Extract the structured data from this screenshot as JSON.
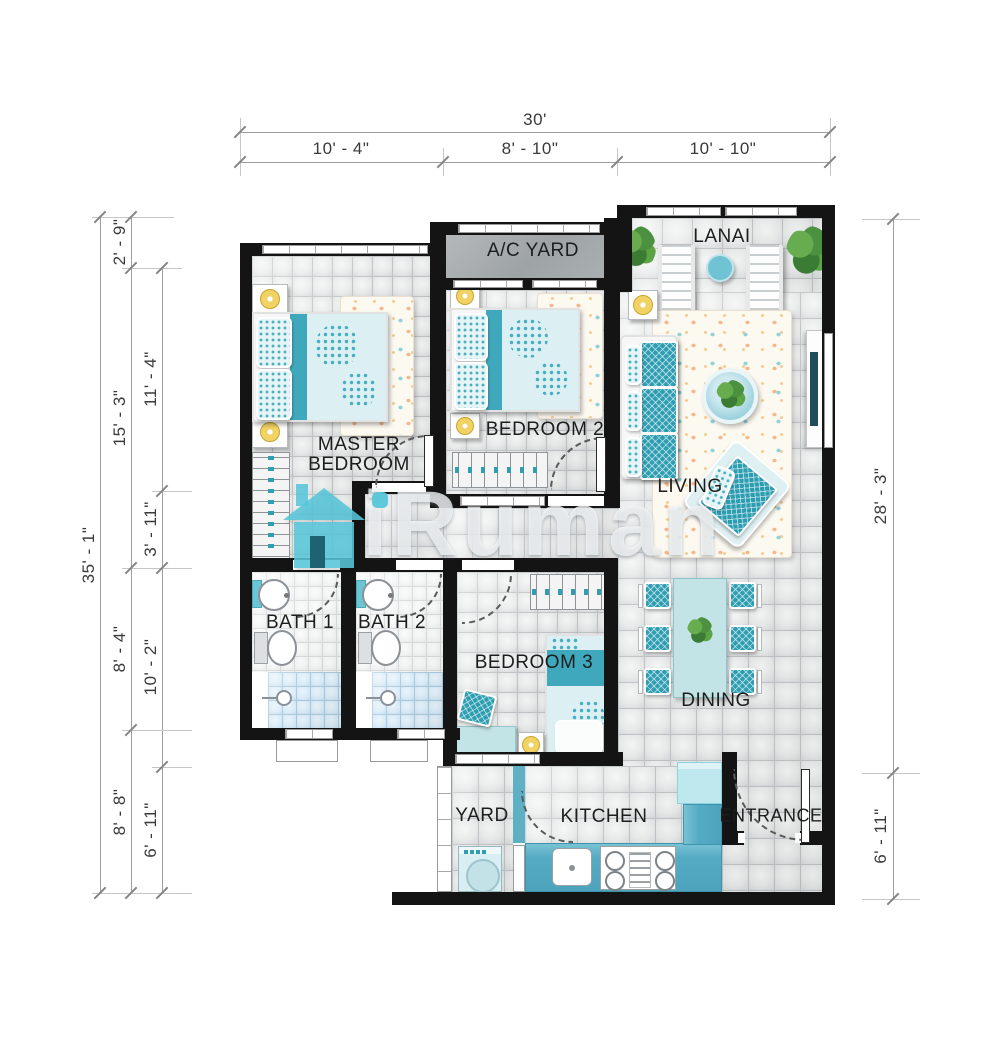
{
  "watermark": {
    "brand": "iRuman",
    "accent": "#56c5d8",
    "house_icon": "house-icon"
  },
  "dimensions": {
    "top": {
      "total": "30'",
      "segments": [
        "10' - 4\"",
        "8' - 10\"",
        "10' - 10\""
      ]
    },
    "left_outer": "35' - 1\"",
    "left_middle": [
      "2' - 9\"",
      "15' - 3\"",
      "8' - 4\"",
      "8' - 8\""
    ],
    "left_inner": [
      "11' - 4\"",
      "3' - 11\"",
      "10' - 2\"",
      "6' - 11\""
    ],
    "right": [
      "28' - 3\"",
      "6' - 11\""
    ]
  },
  "rooms": {
    "ac_yard": "A/C YARD",
    "lanai": "LANAI",
    "master_bedroom": "MASTER BEDROOM",
    "bedroom2": "BEDROOM 2",
    "living": "LIVING",
    "bath1": "BATH 1",
    "bath2": "BATH 2",
    "bedroom3": "BEDROOM 3",
    "dining": "DINING",
    "yard": "YARD",
    "kitchen": "KITCHEN",
    "entrance": "ENTRANCE"
  },
  "colors": {
    "wall": "#141414",
    "accent_teal": "#4db6c9",
    "counter_teal": "#55abc3",
    "bedding_light": "#dcf0f3",
    "shower_blue": "#d9ebf7",
    "lamp_yellow": "#f1d264",
    "plant_green": "#4c9140",
    "rug_coral": "#f5b78e",
    "tile_line": "#bfc3c5"
  }
}
